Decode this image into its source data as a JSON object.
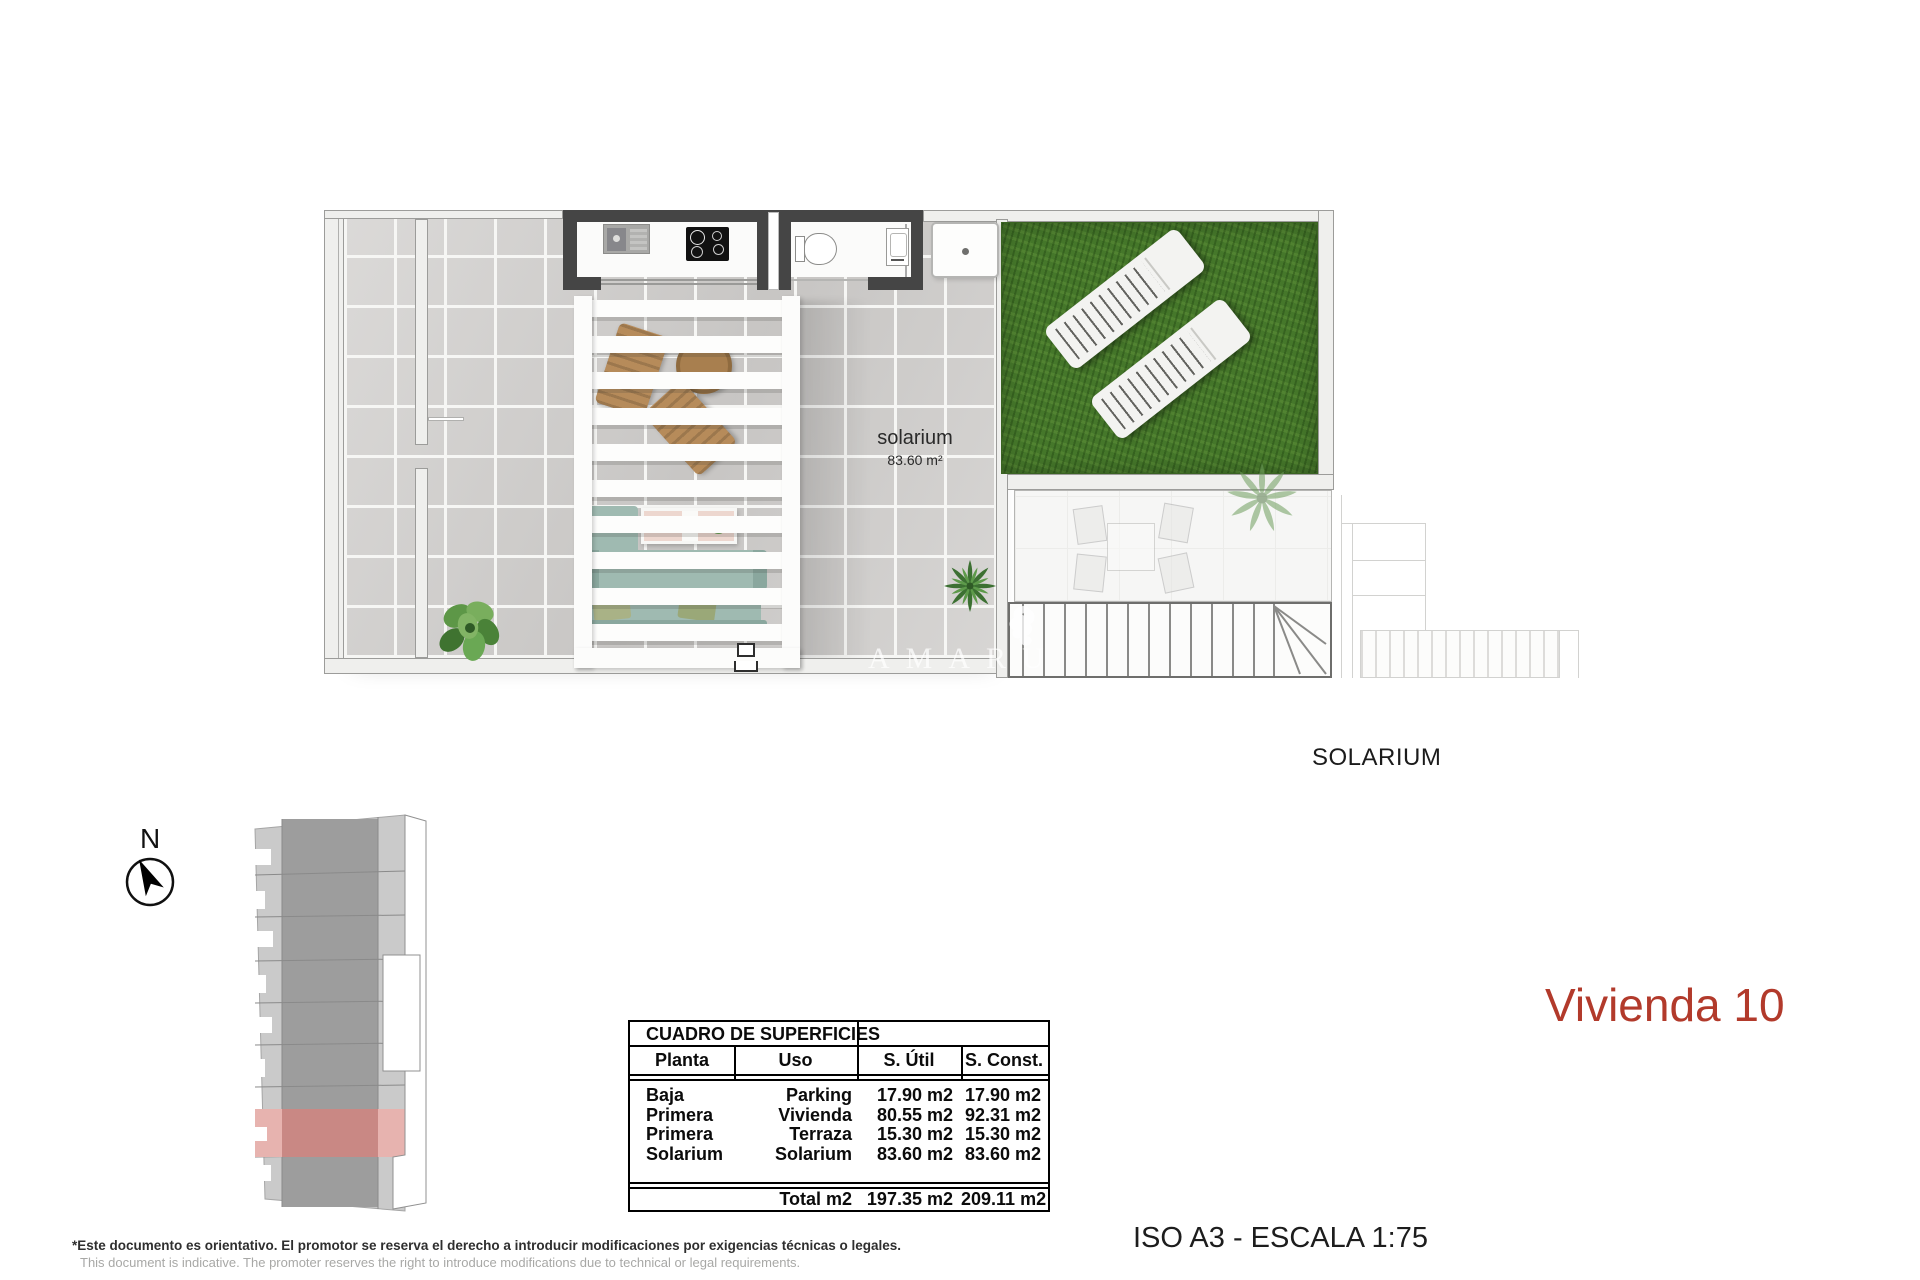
{
  "document": {
    "title": "Vivienda 10",
    "scale_note": "ISO A3 - ESCALA 1:75",
    "caption": "SOLARIUM",
    "disclaimer_es": "*Este documento es orientativo. El promotor se reserva el derecho a introducir modificaciones por exigencias técnicas o legales.",
    "disclaimer_en": "This document is indicative. The promoter reserves the right to introduce modifications due to technical or legal requirements.",
    "watermark": "AMARU",
    "accent_color": "#b23a2b"
  },
  "plan": {
    "room_label": "solarium",
    "room_area": "83.60 m²",
    "grass_color": "#45772a",
    "dark_wall_color": "#454545",
    "tile_color": "#d2d0ce"
  },
  "compass": {
    "north_label": "N"
  },
  "site_plan": {
    "highlight_color": "#c98884",
    "highlight_light_color": "#e7b3af",
    "building_dark": "#9d9d9d",
    "building_light": "#cacaca"
  },
  "surfaces_table": {
    "title": "CUADRO DE SUPERFICIES",
    "headers": [
      "Planta",
      "Uso",
      "S. Útil",
      "S. Const."
    ],
    "rows": [
      [
        "Baja",
        "Parking",
        "17.90 m2",
        "17.90 m2"
      ],
      [
        "Primera",
        "Vivienda",
        "80.55 m2",
        "92.31 m2"
      ],
      [
        "Primera",
        "Terraza",
        "15.30 m2",
        "15.30 m2"
      ],
      [
        "Solarium",
        "Solarium",
        "83.60 m2",
        "83.60 m2"
      ]
    ],
    "total": [
      "",
      "Total m2",
      "197.35 m2",
      "209.11 m2"
    ]
  }
}
